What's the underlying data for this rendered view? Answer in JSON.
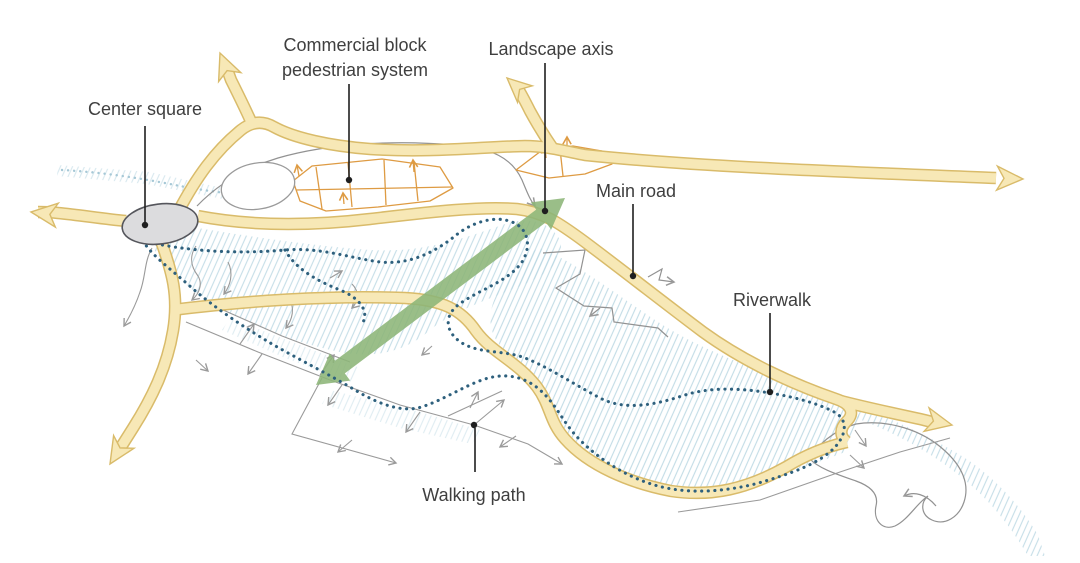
{
  "diagram": {
    "title": "Site concept plan diagram",
    "labels": {
      "center_square": "Center square",
      "commercial_block_line1": "Commercial block",
      "commercial_block_line2": "pedestrian system",
      "landscape_axis": "Landscape axis",
      "main_road": "Main road",
      "riverwalk": "Riverwalk",
      "walking_path": "Walking path"
    },
    "features": [
      {
        "id": "center-square",
        "label": "Center square",
        "symbol": "gray-ellipse"
      },
      {
        "id": "commercial-block-pedestrian-system",
        "label": "Commercial block pedestrian system",
        "symbol": "orange-grid"
      },
      {
        "id": "landscape-axis",
        "label": "Landscape axis",
        "symbol": "green-double-arrow"
      },
      {
        "id": "main-road",
        "label": "Main road",
        "symbol": "yellow-road"
      },
      {
        "id": "riverwalk",
        "label": "Riverwalk",
        "symbol": "blue-dotted-line"
      },
      {
        "id": "walking-path",
        "label": "Walking path",
        "symbol": "gray-line-arrows"
      }
    ],
    "icons": {
      "road_arrow": "barbed-triangle-arrowhead",
      "path_arrow": "open-chevron-arrowhead",
      "leader_dot": "filled-circle"
    }
  },
  "colors": {
    "road_fill": "#F7E8B6",
    "road_border": "#D9BB6A",
    "hatch_blue": "#B9D7E2",
    "riverwalk_dot": "#2E607D",
    "path_gray": "#9A9A9A",
    "boundary_gray": "#929292",
    "orange": "#DE9B43",
    "green_axis": "#8CB577",
    "square_fill": "#DCDCDE",
    "square_border": "#55565C",
    "label_text": "#3F3F3F",
    "leader_line": "#1F1F1F"
  }
}
